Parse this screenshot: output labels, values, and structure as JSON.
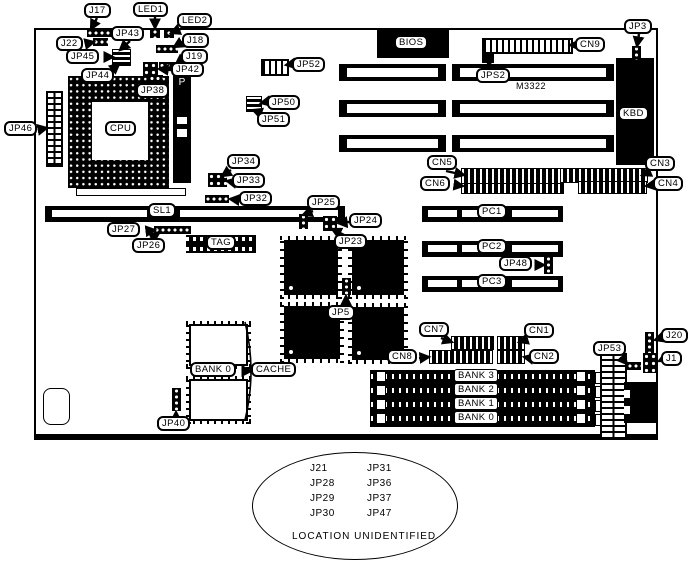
{
  "diagram": "motherboard-layout",
  "labels": {
    "j17": "J17",
    "led1": "LED1",
    "led2": "LED2",
    "j22": "J22",
    "jp43": "JP43",
    "j18": "J18",
    "jp45": "JP45",
    "j19": "J19",
    "jp44": "JP44",
    "jp42": "JP42",
    "jp38": "JP38",
    "jp46": "JP46",
    "cpu": "CPU",
    "amp": "AMP",
    "jp52": "JP52",
    "jp50": "JP50",
    "jp51": "JP51",
    "bios": "BIOS",
    "jps2": "JPS2",
    "m3322": "M3322",
    "cn9": "CN9",
    "jp3": "JP3",
    "kbd": "KBD",
    "jp34": "JP34",
    "jp33": "JP33",
    "jp32": "JP32",
    "cn5": "CN5",
    "cn6": "CN6",
    "cn3": "CN3",
    "cn4": "CN4",
    "sl1": "SL1",
    "jp27": "JP27",
    "jp26": "JP26",
    "tag": "TAG",
    "jp25": "JP25",
    "jp24": "JP24",
    "jp23": "JP23",
    "pc1": "PC1",
    "pc2": "PC2",
    "pc3": "PC3",
    "jp48": "JP48",
    "jp5": "JP5",
    "cn7": "CN7",
    "cn1": "CN1",
    "cn8": "CN8",
    "cn2": "CN2",
    "cache_bank": "BANK 0",
    "cache": "CACHE",
    "jp40": "JP40",
    "jp53": "JP53",
    "j20": "J20",
    "j1": "J1"
  },
  "banks": [
    "BANK 3",
    "BANK 2",
    "BANK 1",
    "BANK 0"
  ],
  "unidentified": {
    "col1": [
      "J21",
      "JP28",
      "JP29",
      "JP30"
    ],
    "col2": [
      "JP31",
      "JP36",
      "JP37",
      "JP47"
    ],
    "note": "LOCATION UNIDENTIFIED"
  }
}
